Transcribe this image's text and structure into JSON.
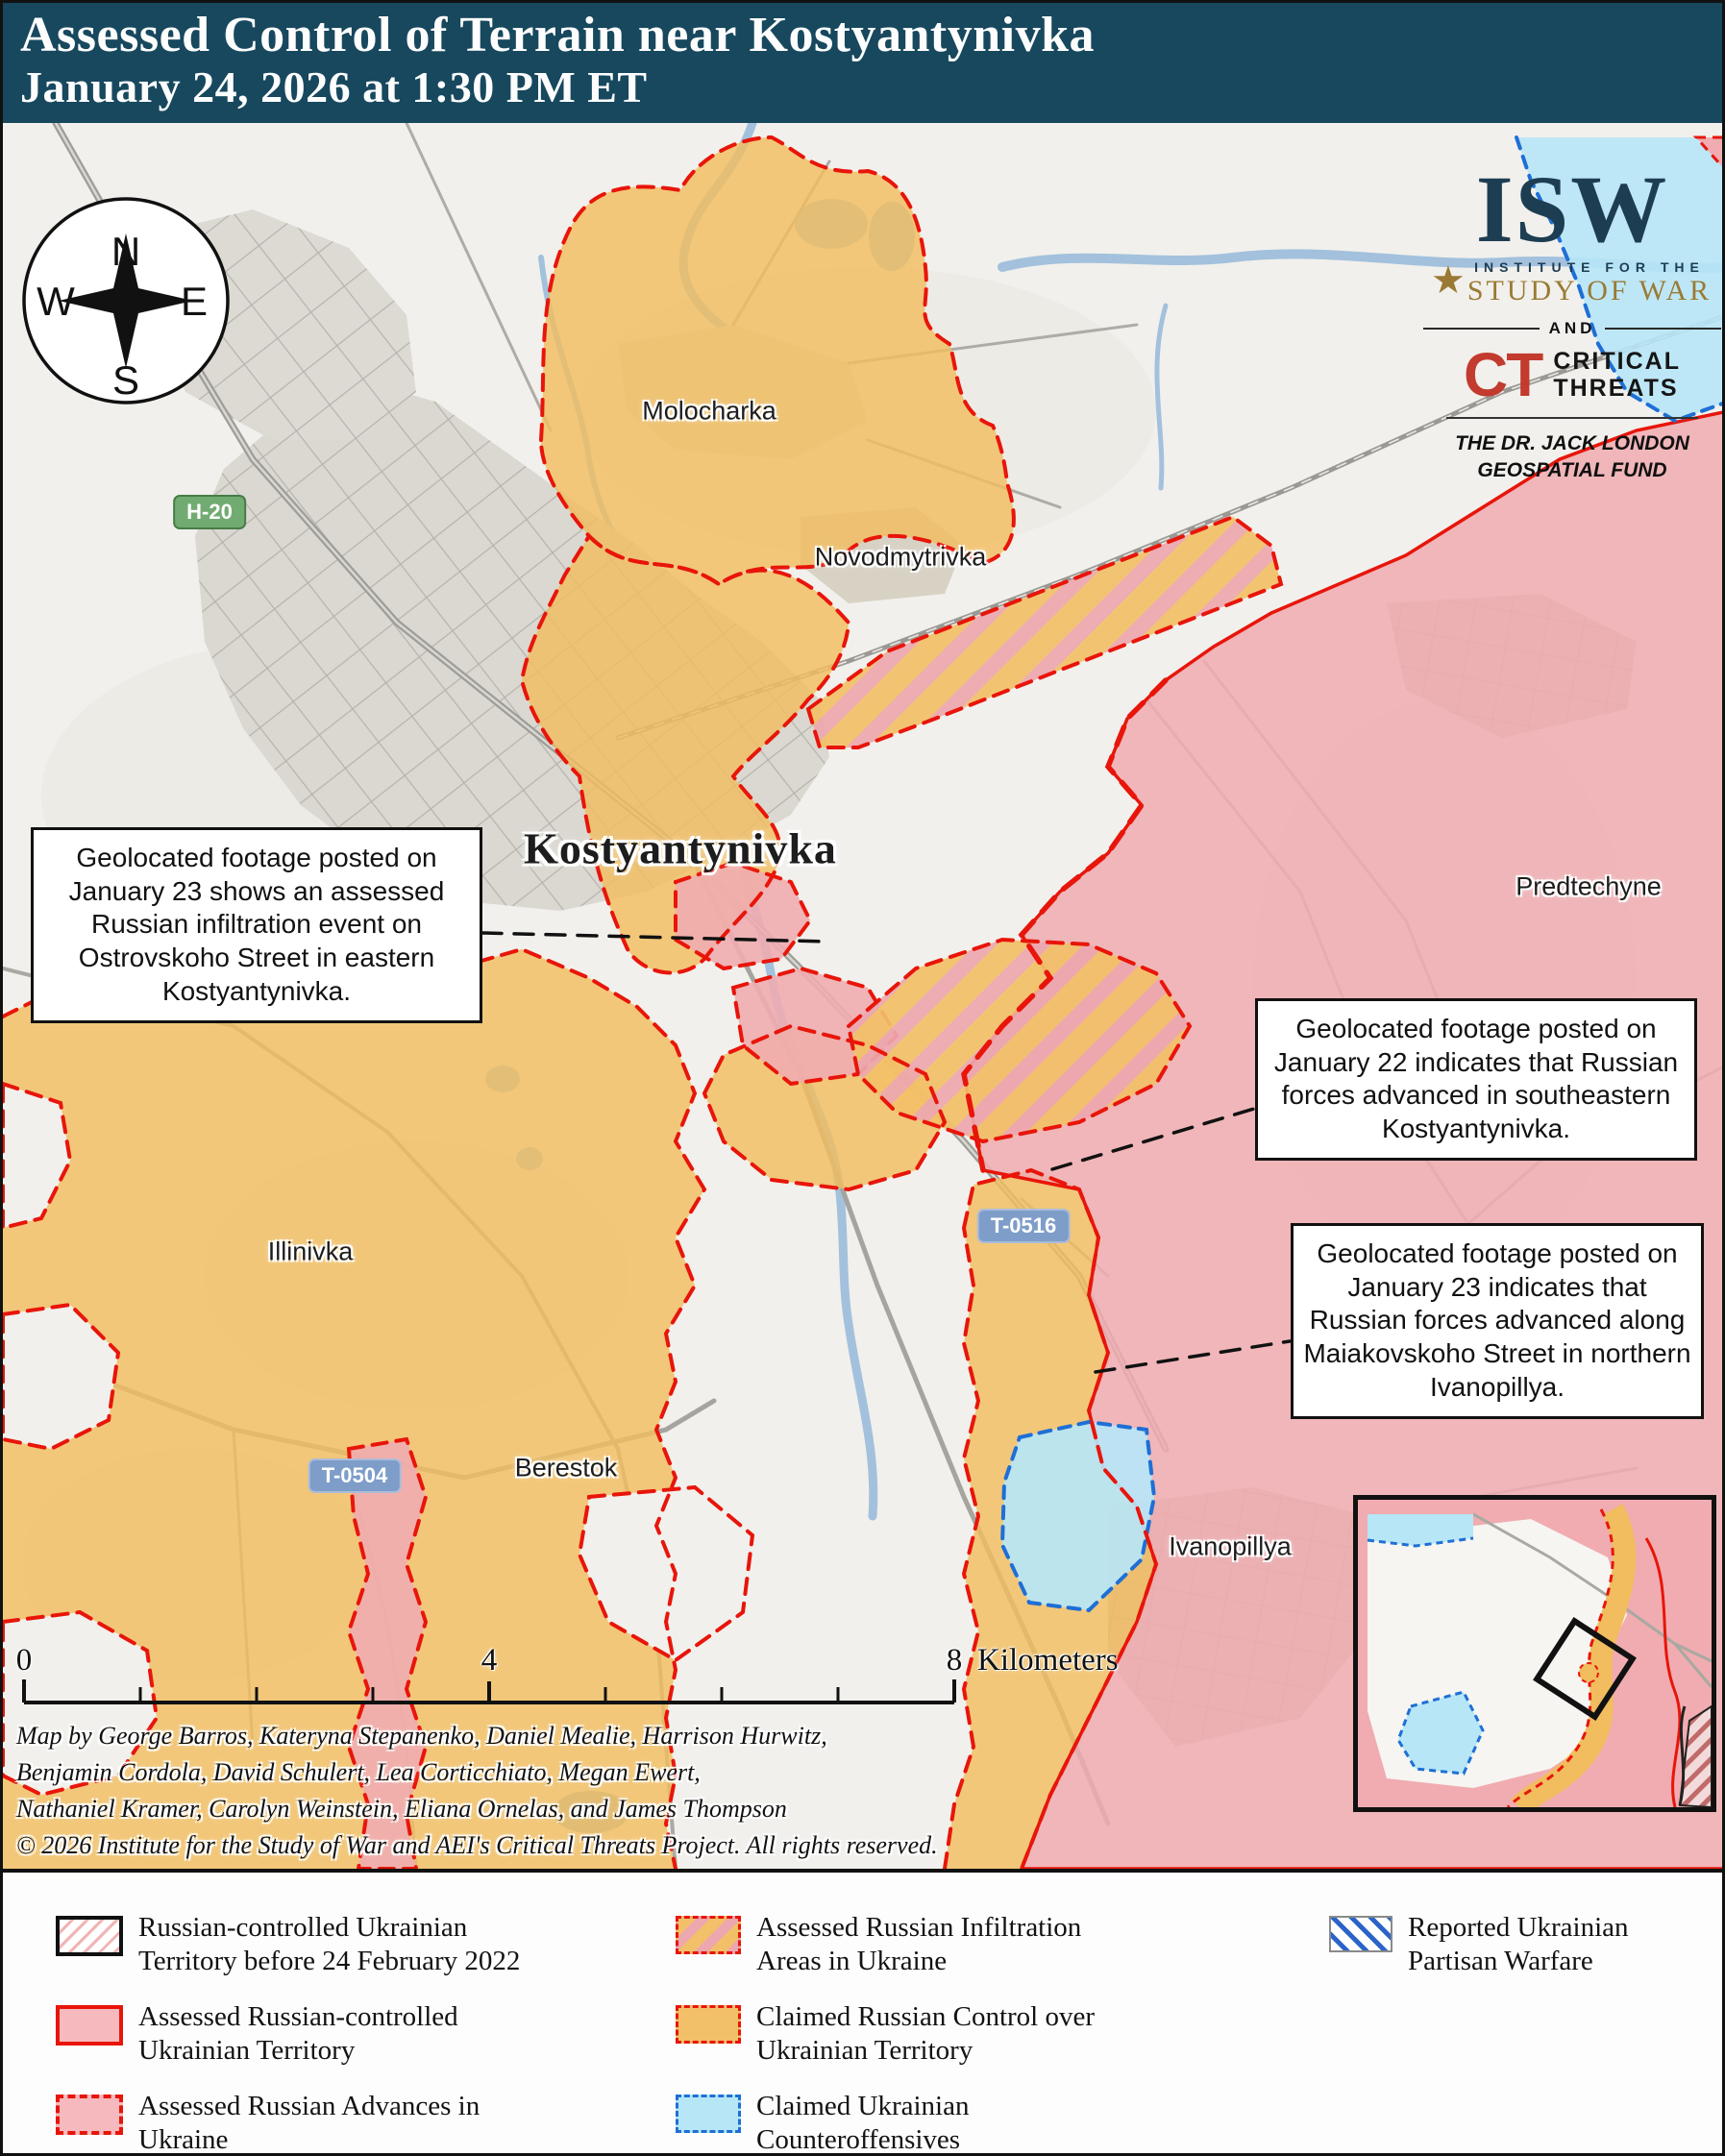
{
  "header": {
    "title": "Assessed Control of Terrain near Kostyantynivka",
    "subtitle": "January 24, 2026 at 1:30 PM ET"
  },
  "branding": {
    "isw": {
      "acronym": "ISW",
      "star": "★",
      "institute": "INSTITUTE FOR THE",
      "study": "STUDY OF WAR"
    },
    "and_label": "AND",
    "ct": {
      "acronym": "CT",
      "line1": "CRITICAL",
      "line2": "THREATS"
    },
    "fund": {
      "line1": "THE DR. JACK LONDON",
      "line2": "GEOSPATIAL FUND"
    }
  },
  "compass": {
    "north": "N",
    "east": "E",
    "south": "S",
    "west": "W"
  },
  "map": {
    "places": {
      "molocharka": "Molocharka",
      "novodmytrivka": "Novodmytrivka",
      "kostyantynivka": "Kostyantynivka",
      "predtechyne": "Predtechyne",
      "illinivka": "Illinivka",
      "berestok": "Berestok",
      "ivanopillya": "Ivanopillya"
    },
    "roads": {
      "h20": "H-20",
      "t0516": "T-0516",
      "t0504": "T-0504"
    },
    "callouts": [
      {
        "text": "Geolocated footage posted on January 23 shows an assessed Russian infiltration event on Ostrovskoho Street in eastern Kostyantynivka."
      },
      {
        "text": "Geolocated footage posted on January 22 indicates that Russian forces advanced in southeastern Kostyantynivka."
      },
      {
        "text": "Geolocated footage posted on January 23 indicates that Russian forces advanced along Maiakovskoho Street in northern Ivanopillya."
      }
    ]
  },
  "scalebar": {
    "start": "0",
    "mid": "4",
    "end": "8",
    "unit": "Kilometers"
  },
  "credits": {
    "line1": "Map by George Barros, Kateryna Stepanenko, Daniel Mealie, Harrison Hurwitz,",
    "line2": "Benjamin Cordola, David Schulert, Lea Corticchiato, Megan Ewert,",
    "line3": "Nathaniel Kramer, Carolyn Weinstein, Eliana Ornelas, and James Thompson",
    "line4": "© 2026 Institute for the Study of War and AEI's Critical Threats Project. All rights reserved."
  },
  "legend": {
    "items": [
      {
        "id": "prewar",
        "line1": "Russian-controlled Ukrainian",
        "line2": "Territory before 24 February 2022"
      },
      {
        "id": "assessed",
        "line1": "Assessed Russian-controlled",
        "line2": "Ukrainian Territory"
      },
      {
        "id": "advances",
        "line1": "Assessed Russian Advances in",
        "line2": "Ukraine"
      },
      {
        "id": "infiltration",
        "line1": "Assessed Russian Infiltration",
        "line2": "Areas in Ukraine"
      },
      {
        "id": "claimed",
        "line1": "Claimed Russian Control over",
        "line2": "Ukrainian Territory"
      },
      {
        "id": "counteroffensives",
        "line1": "Claimed Ukrainian",
        "line2": "Counteroffensives"
      },
      {
        "id": "partisan",
        "line1": "Reported Ukrainian",
        "line2": "Partisan Warfare"
      }
    ]
  },
  "colors": {
    "header_bg": "#17485e",
    "claimed_orange": "#f2c068",
    "assessed_pink": "#f3b3b7",
    "counteroffensive_cyan": "#b7e6f7",
    "advance_red": "#e8150a",
    "counteroffensive_blue": "#1e6fd6",
    "partisan_blue": "#2b63c9",
    "isw_navy": "#1d3d52",
    "isw_gold": "#9a7a33",
    "ct_red": "#c23b2e"
  }
}
